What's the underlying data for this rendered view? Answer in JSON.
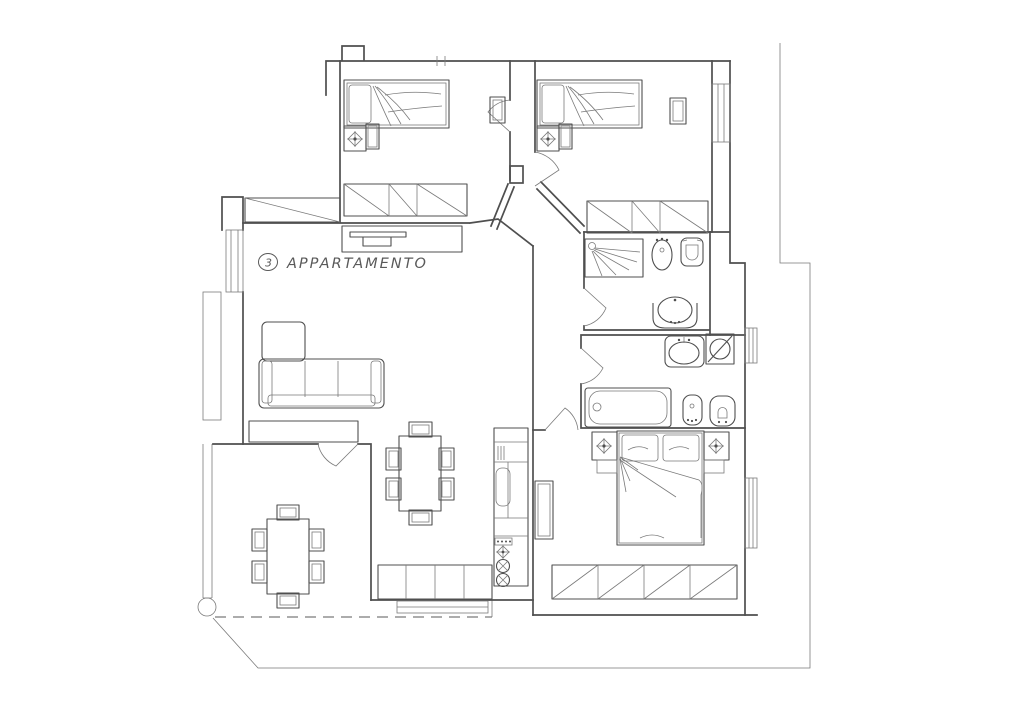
{
  "plan": {
    "unit_number": "3",
    "label": "APPARTAMENTO",
    "colors": {
      "line": "#4f4f4f",
      "thin": "#7a7a7a",
      "background": "#ffffff"
    },
    "rooms": [
      "bedroom-top-left",
      "bedroom-top-right",
      "bathroom-shower",
      "bathroom-bathtub",
      "double-bedroom",
      "living-dining-room",
      "kitchen-strip",
      "terrace",
      "balcony"
    ],
    "furniture_icons": [
      "single-bed",
      "single-bed",
      "double-bed",
      "pillow",
      "nightstand",
      "ceiling-light",
      "wardrobe",
      "long-closet",
      "radiator",
      "tv-cabinet",
      "corner-sofa",
      "sideboard",
      "dining-table",
      "chair",
      "kitchen-counter",
      "kitchen-sink",
      "cooktop-burner",
      "shower",
      "bidet",
      "toilet",
      "washbasin",
      "bathtub",
      "washing-machine",
      "terrace-table",
      "column",
      "terrace-boundary-dashed"
    ]
  }
}
